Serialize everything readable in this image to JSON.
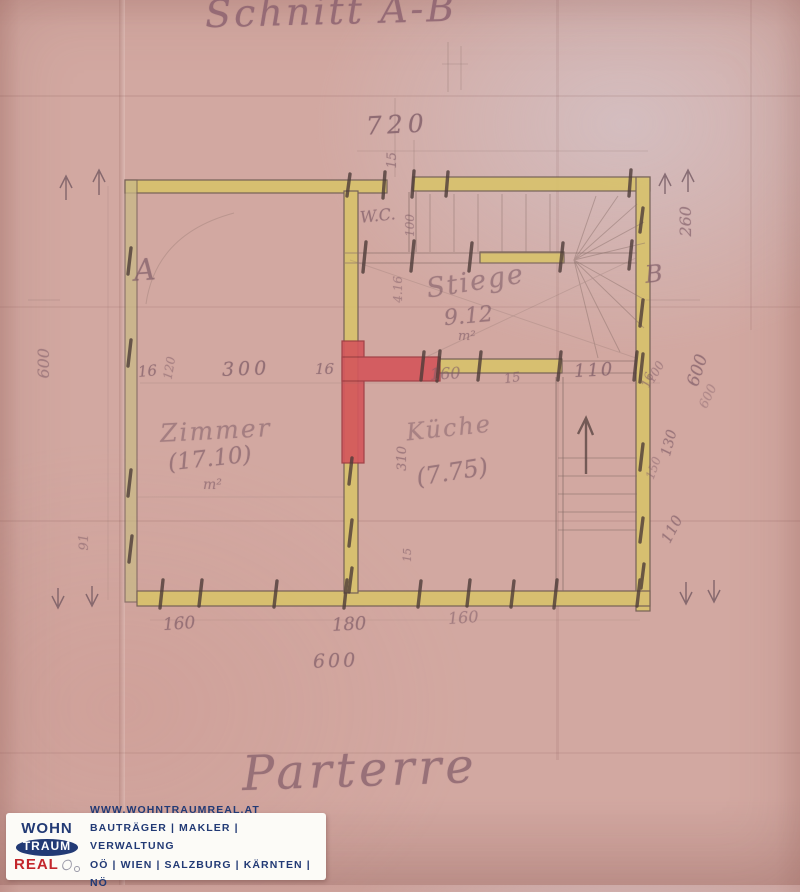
{
  "page": {
    "title": "Schnitt A-B",
    "floor_label": "Parterre"
  },
  "plan": {
    "room_labels": {
      "wc": "W.C.",
      "stiege_name": "Stiege",
      "stiege_area": "9.12",
      "stiege_unit": "m²",
      "zimmer_name": "Zimmer",
      "zimmer_area": "(17.10)",
      "zimmer_unit": "m²",
      "kueche_name": "Küche",
      "kueche_area": "(7.75)"
    },
    "section_markers": {
      "a": "A",
      "b": "B"
    },
    "dims": {
      "top_width": "720",
      "top_wall_thickness": "15",
      "mid_16a": "16",
      "mid_120": "120",
      "mid_300": "300",
      "mid_16b": "16",
      "mid_160": "160",
      "mid_15": "15",
      "mid_110": "110",
      "mid_16c": "16",
      "wc_100": "100",
      "stair_416": "4.16",
      "kueche_310": "310",
      "kueche_15": "15",
      "bottom_160a": "160",
      "bottom_180": "180",
      "bottom_160b": "160",
      "bottom_600": "600",
      "left_600": "600",
      "left_91": "91",
      "right_260": "260",
      "right_100": "100",
      "right_600": "600",
      "right_600b": "600",
      "right_130": "130",
      "right_150": "150",
      "right_110": "110"
    }
  },
  "logo": {
    "wohn": "WOHN",
    "traum": "TRAUM",
    "real": "REAL",
    "website": "WWW.WOHNTRAUMREAL.AT",
    "services": "BAUTRÄGER | MAKLER | VERWALTUNG",
    "regions": "OÖ | WIEN | SALZBURG | KÄRNTEN | NÖ"
  },
  "colors": {
    "paper": "#d2a8a1",
    "wall_yellow": "#d8c26b",
    "wall_red": "#d4575c",
    "ink": "#7f5c67",
    "logo_blue": "#223a75",
    "logo_red": "#c3262c"
  }
}
